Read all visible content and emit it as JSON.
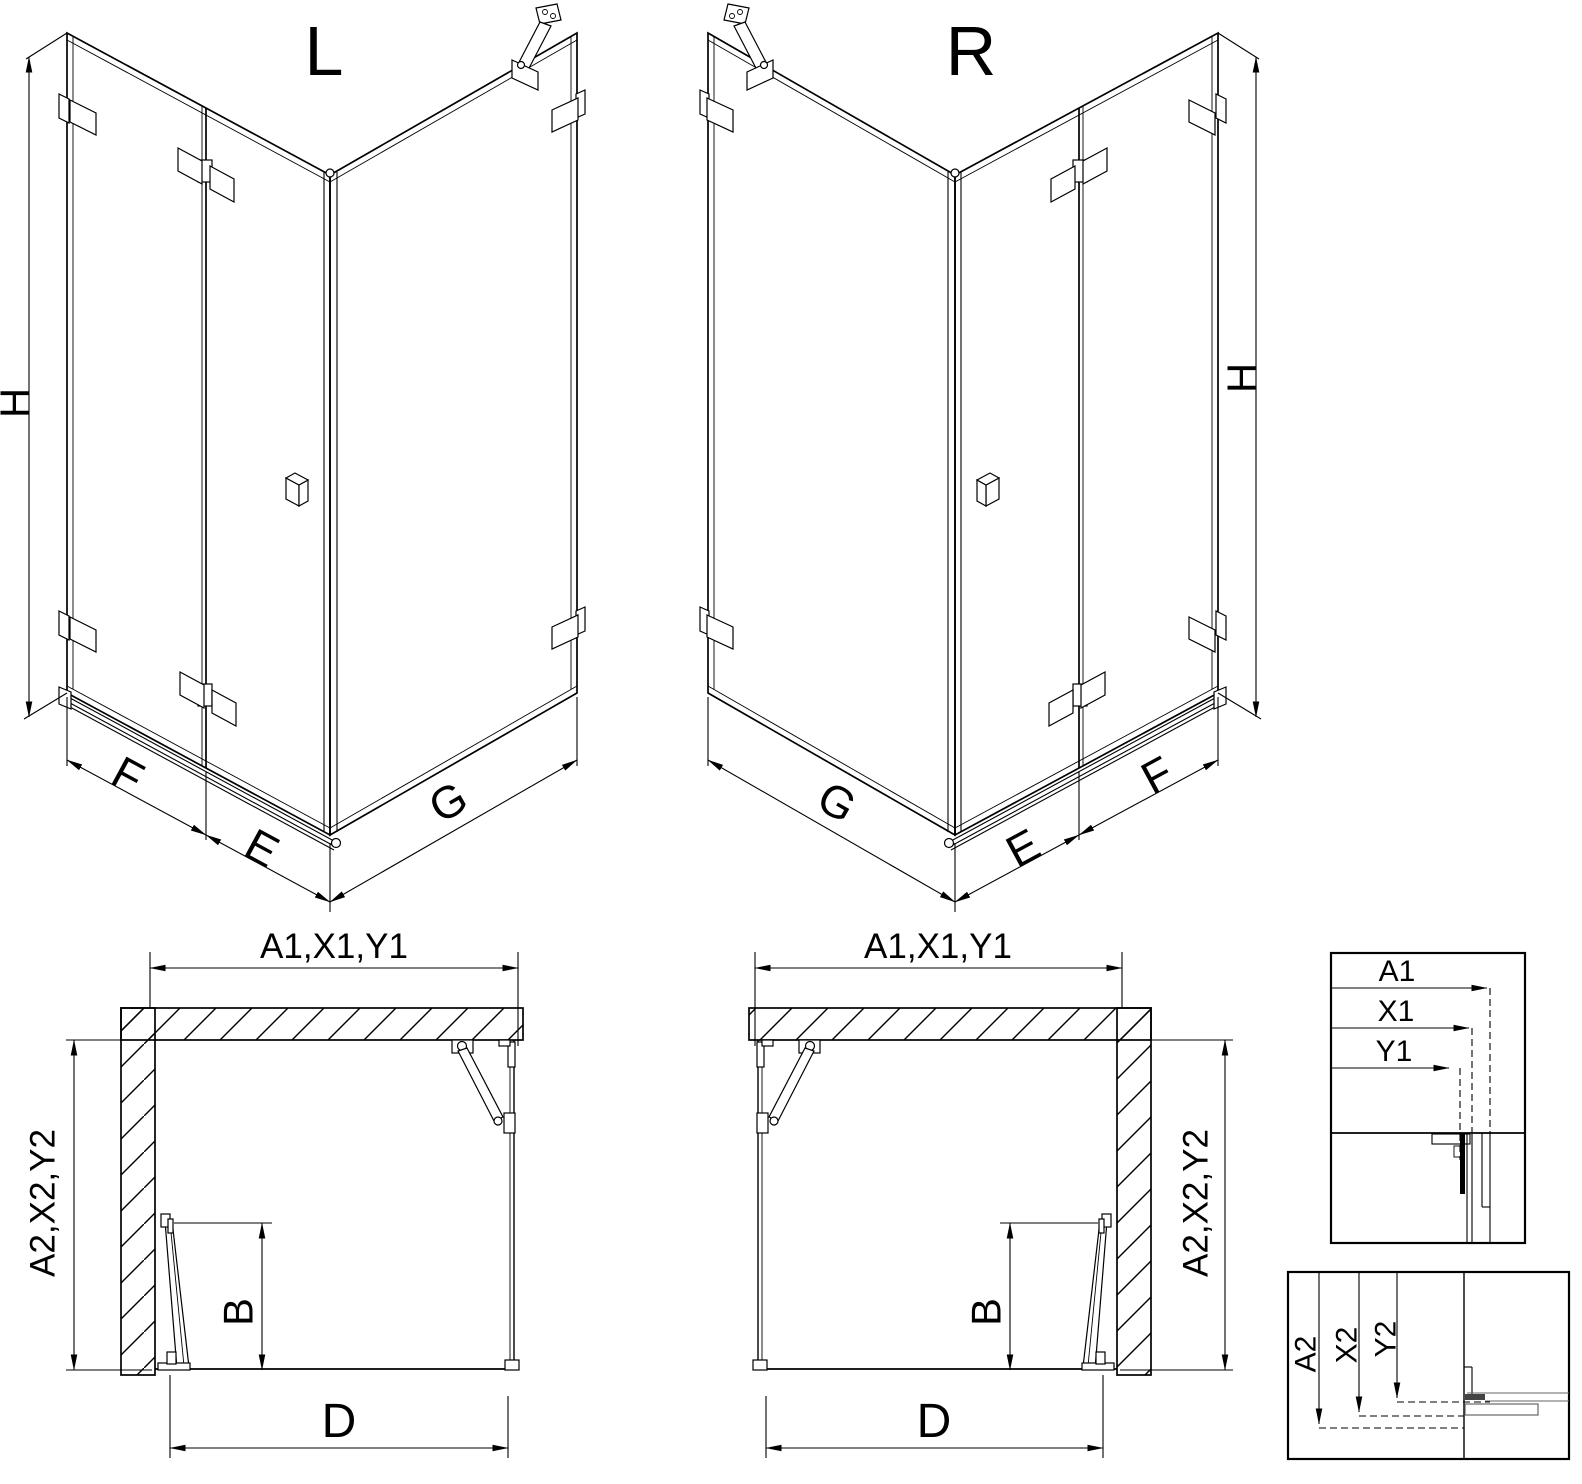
{
  "page": {
    "background": "#ffffff",
    "line_color": "#000000"
  },
  "iso_left": {
    "label": "L",
    "dim_height": "H",
    "dim_fixed": "F",
    "dim_door": "E",
    "dim_side": "G"
  },
  "iso_right": {
    "label": "R",
    "dim_height": "H",
    "dim_fixed": "F",
    "dim_door": "E",
    "dim_side": "G"
  },
  "plan_left": {
    "dim_width": "A1,X1,Y1",
    "dim_depth": "A2,X2,Y2",
    "dim_door": "B",
    "dim_entry": "D"
  },
  "plan_right": {
    "dim_width": "A1,X1,Y1",
    "dim_depth": "A2,X2,Y2",
    "dim_door": "B",
    "dim_entry": "D"
  },
  "detail_width": {
    "labels": [
      "A1",
      "X1",
      "Y1"
    ]
  },
  "detail_depth": {
    "labels": [
      "A2",
      "X2",
      "Y2"
    ]
  }
}
